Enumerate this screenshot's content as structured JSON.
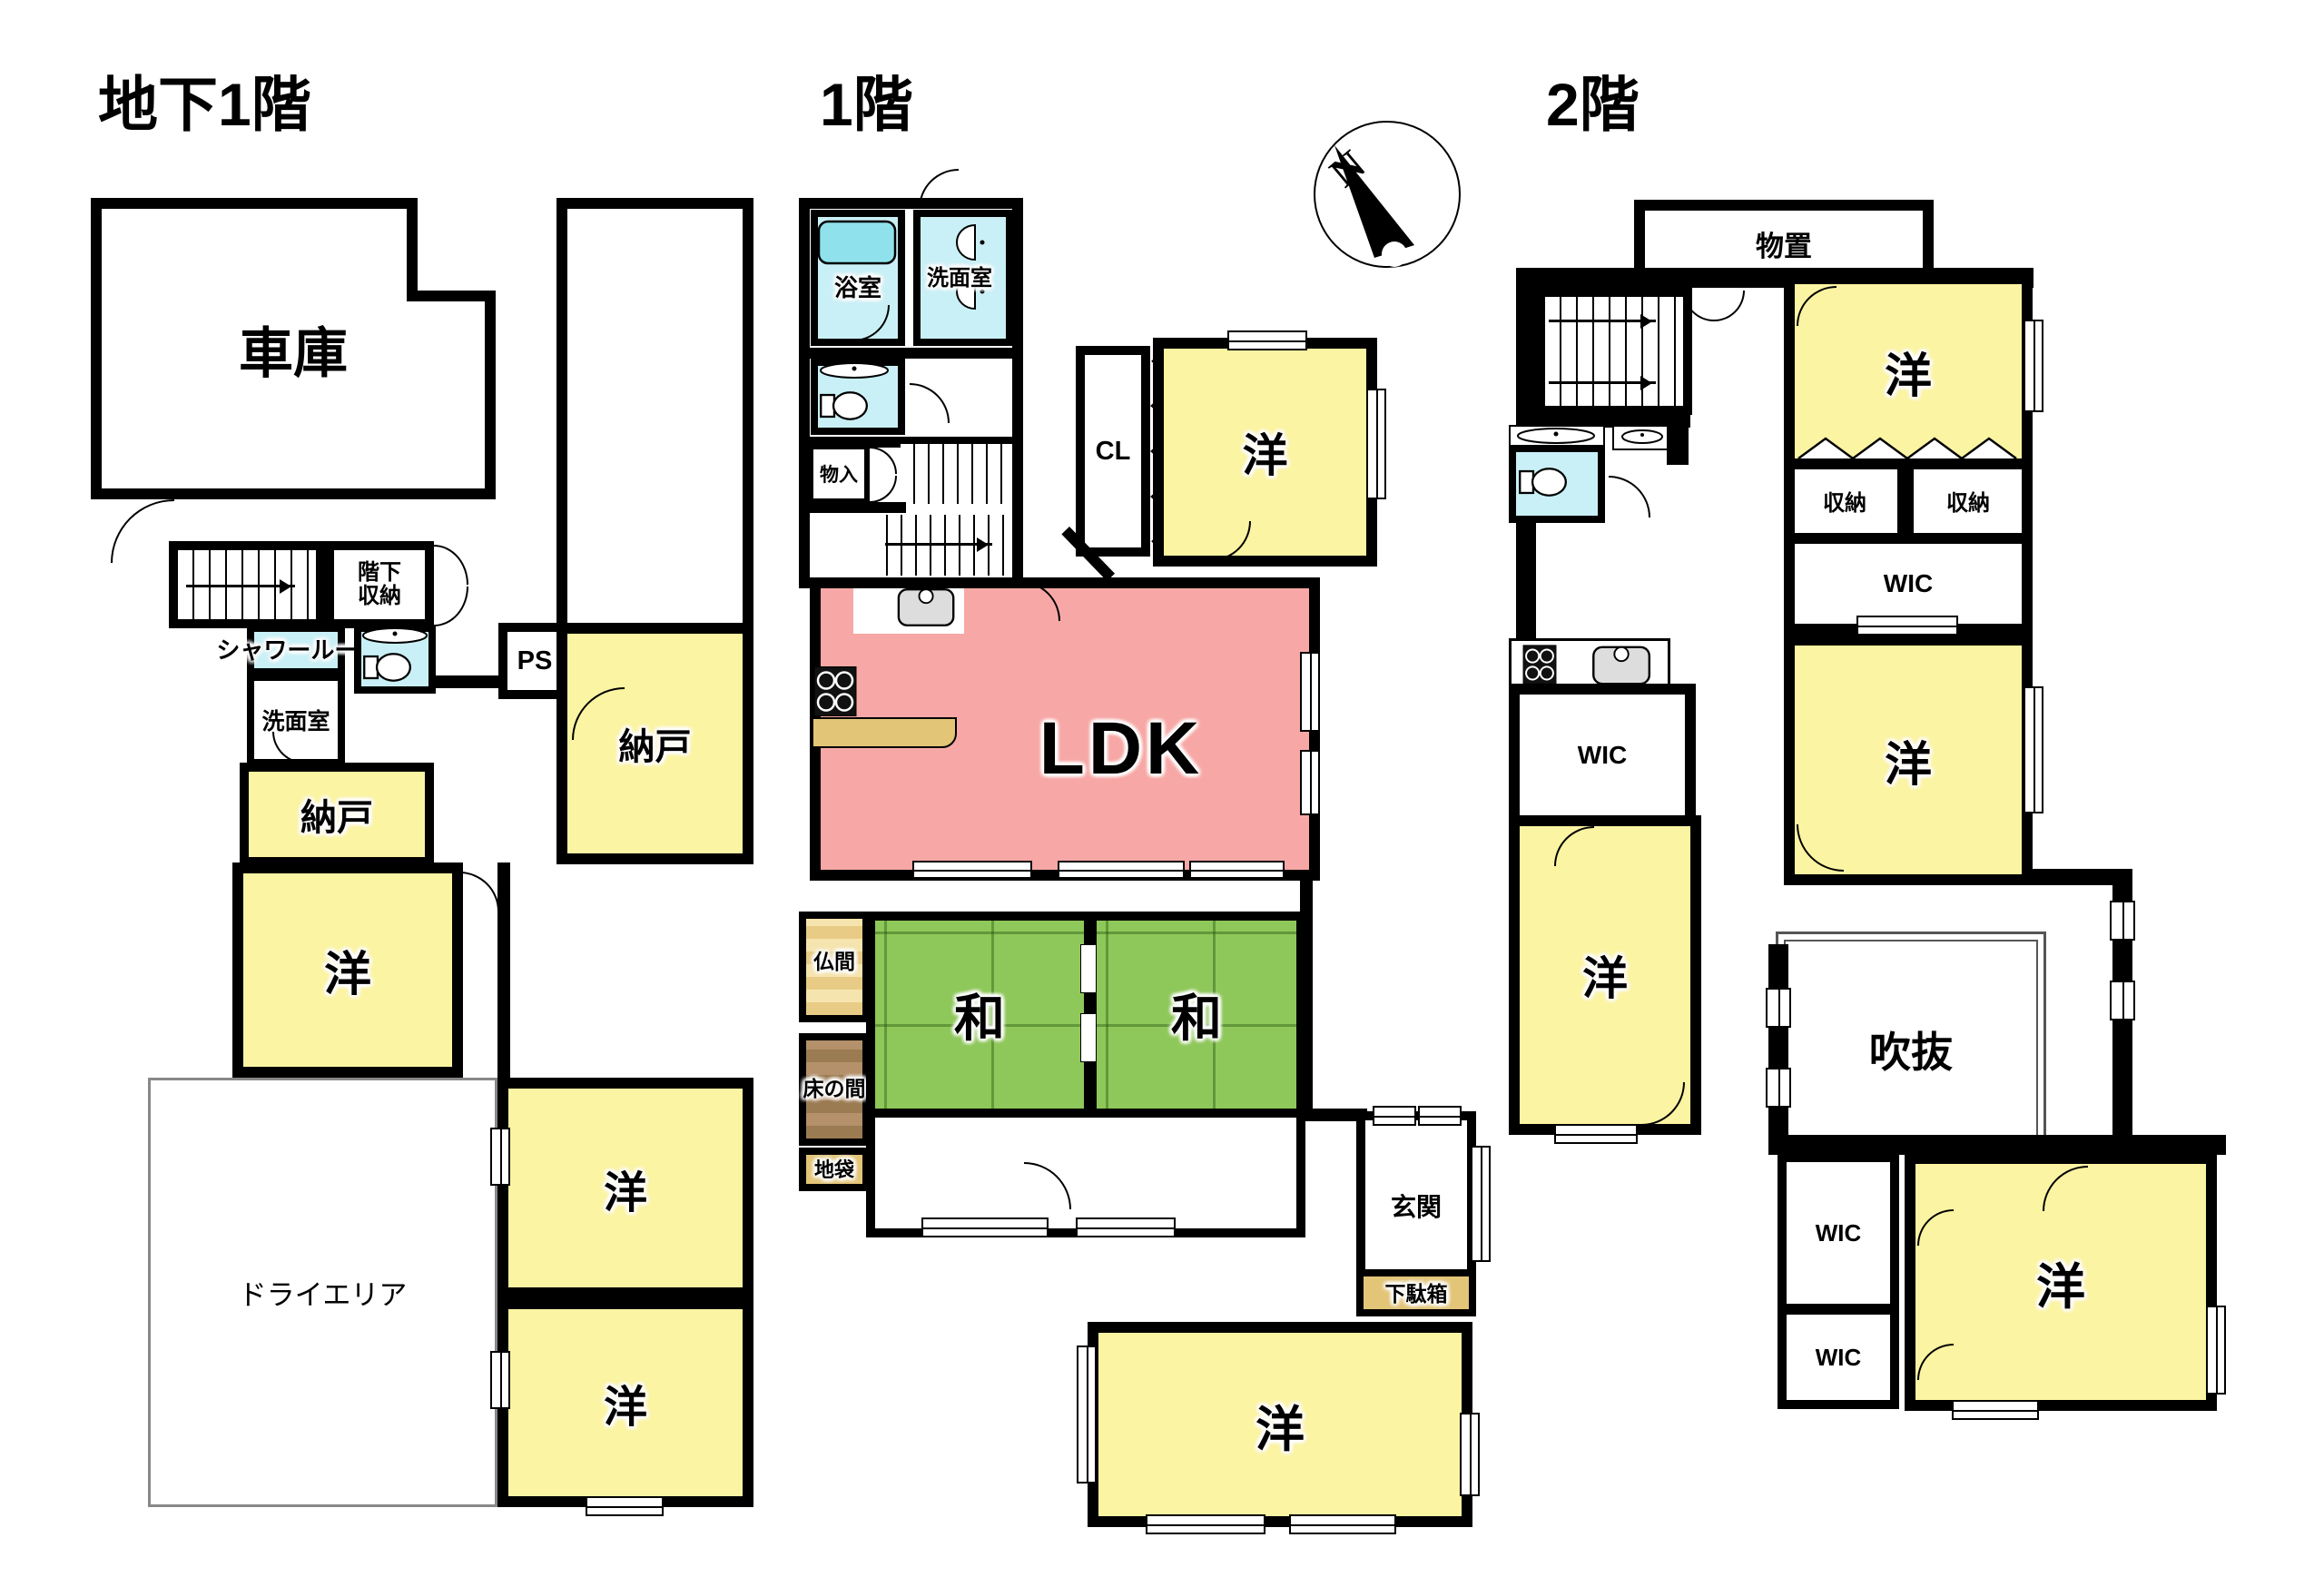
{
  "compass": {
    "north": "N"
  },
  "floors": {
    "b1f": {
      "title": "地下1階",
      "garage": "車庫",
      "under_stairs": "階下収納",
      "shower": "シャワールーム",
      "washroom": "洗面室",
      "ps": "PS",
      "storeroom_a": "納戸",
      "storeroom_b": "納戸",
      "western_a": "洋",
      "dry_area": "ドライエリア",
      "western_b": "洋",
      "western_c": "洋"
    },
    "f1": {
      "title": "1階",
      "bath": "浴室",
      "washroom": "洗面室",
      "storage": "物入",
      "closet": "CL",
      "western_ne": "洋",
      "ldk": "LDK",
      "butsuma": "仏間",
      "tokonoma": "床の間",
      "jibukuro": "地袋",
      "japanese_a": "和",
      "japanese_b": "和",
      "genkan": "玄関",
      "getabako": "下駄箱",
      "western_s": "洋"
    },
    "f2": {
      "title": "2階",
      "storage": "物置",
      "western_ne": "洋",
      "closet_a": "収納",
      "closet_b": "収納",
      "wic_ne": "WIC",
      "western_e": "洋",
      "wic_w": "WIC",
      "western_w": "洋",
      "fukinuke": "吹抜",
      "wic_sw_a": "WIC",
      "wic_sw_b": "WIC",
      "western_se": "洋"
    }
  },
  "colors": {
    "wall": "#000000",
    "room_yellow": "#FBF4A2",
    "tatami_green": "#8FC85A",
    "ldk_pink": "#F7A8A6",
    "water_cyan": "#C9F0F6",
    "bathtub_cyan": "#8FE2EC",
    "wood_tan": "#E3C578",
    "tokonoma_brown": "#9B7B52",
    "dry_area_border": "#888888"
  }
}
